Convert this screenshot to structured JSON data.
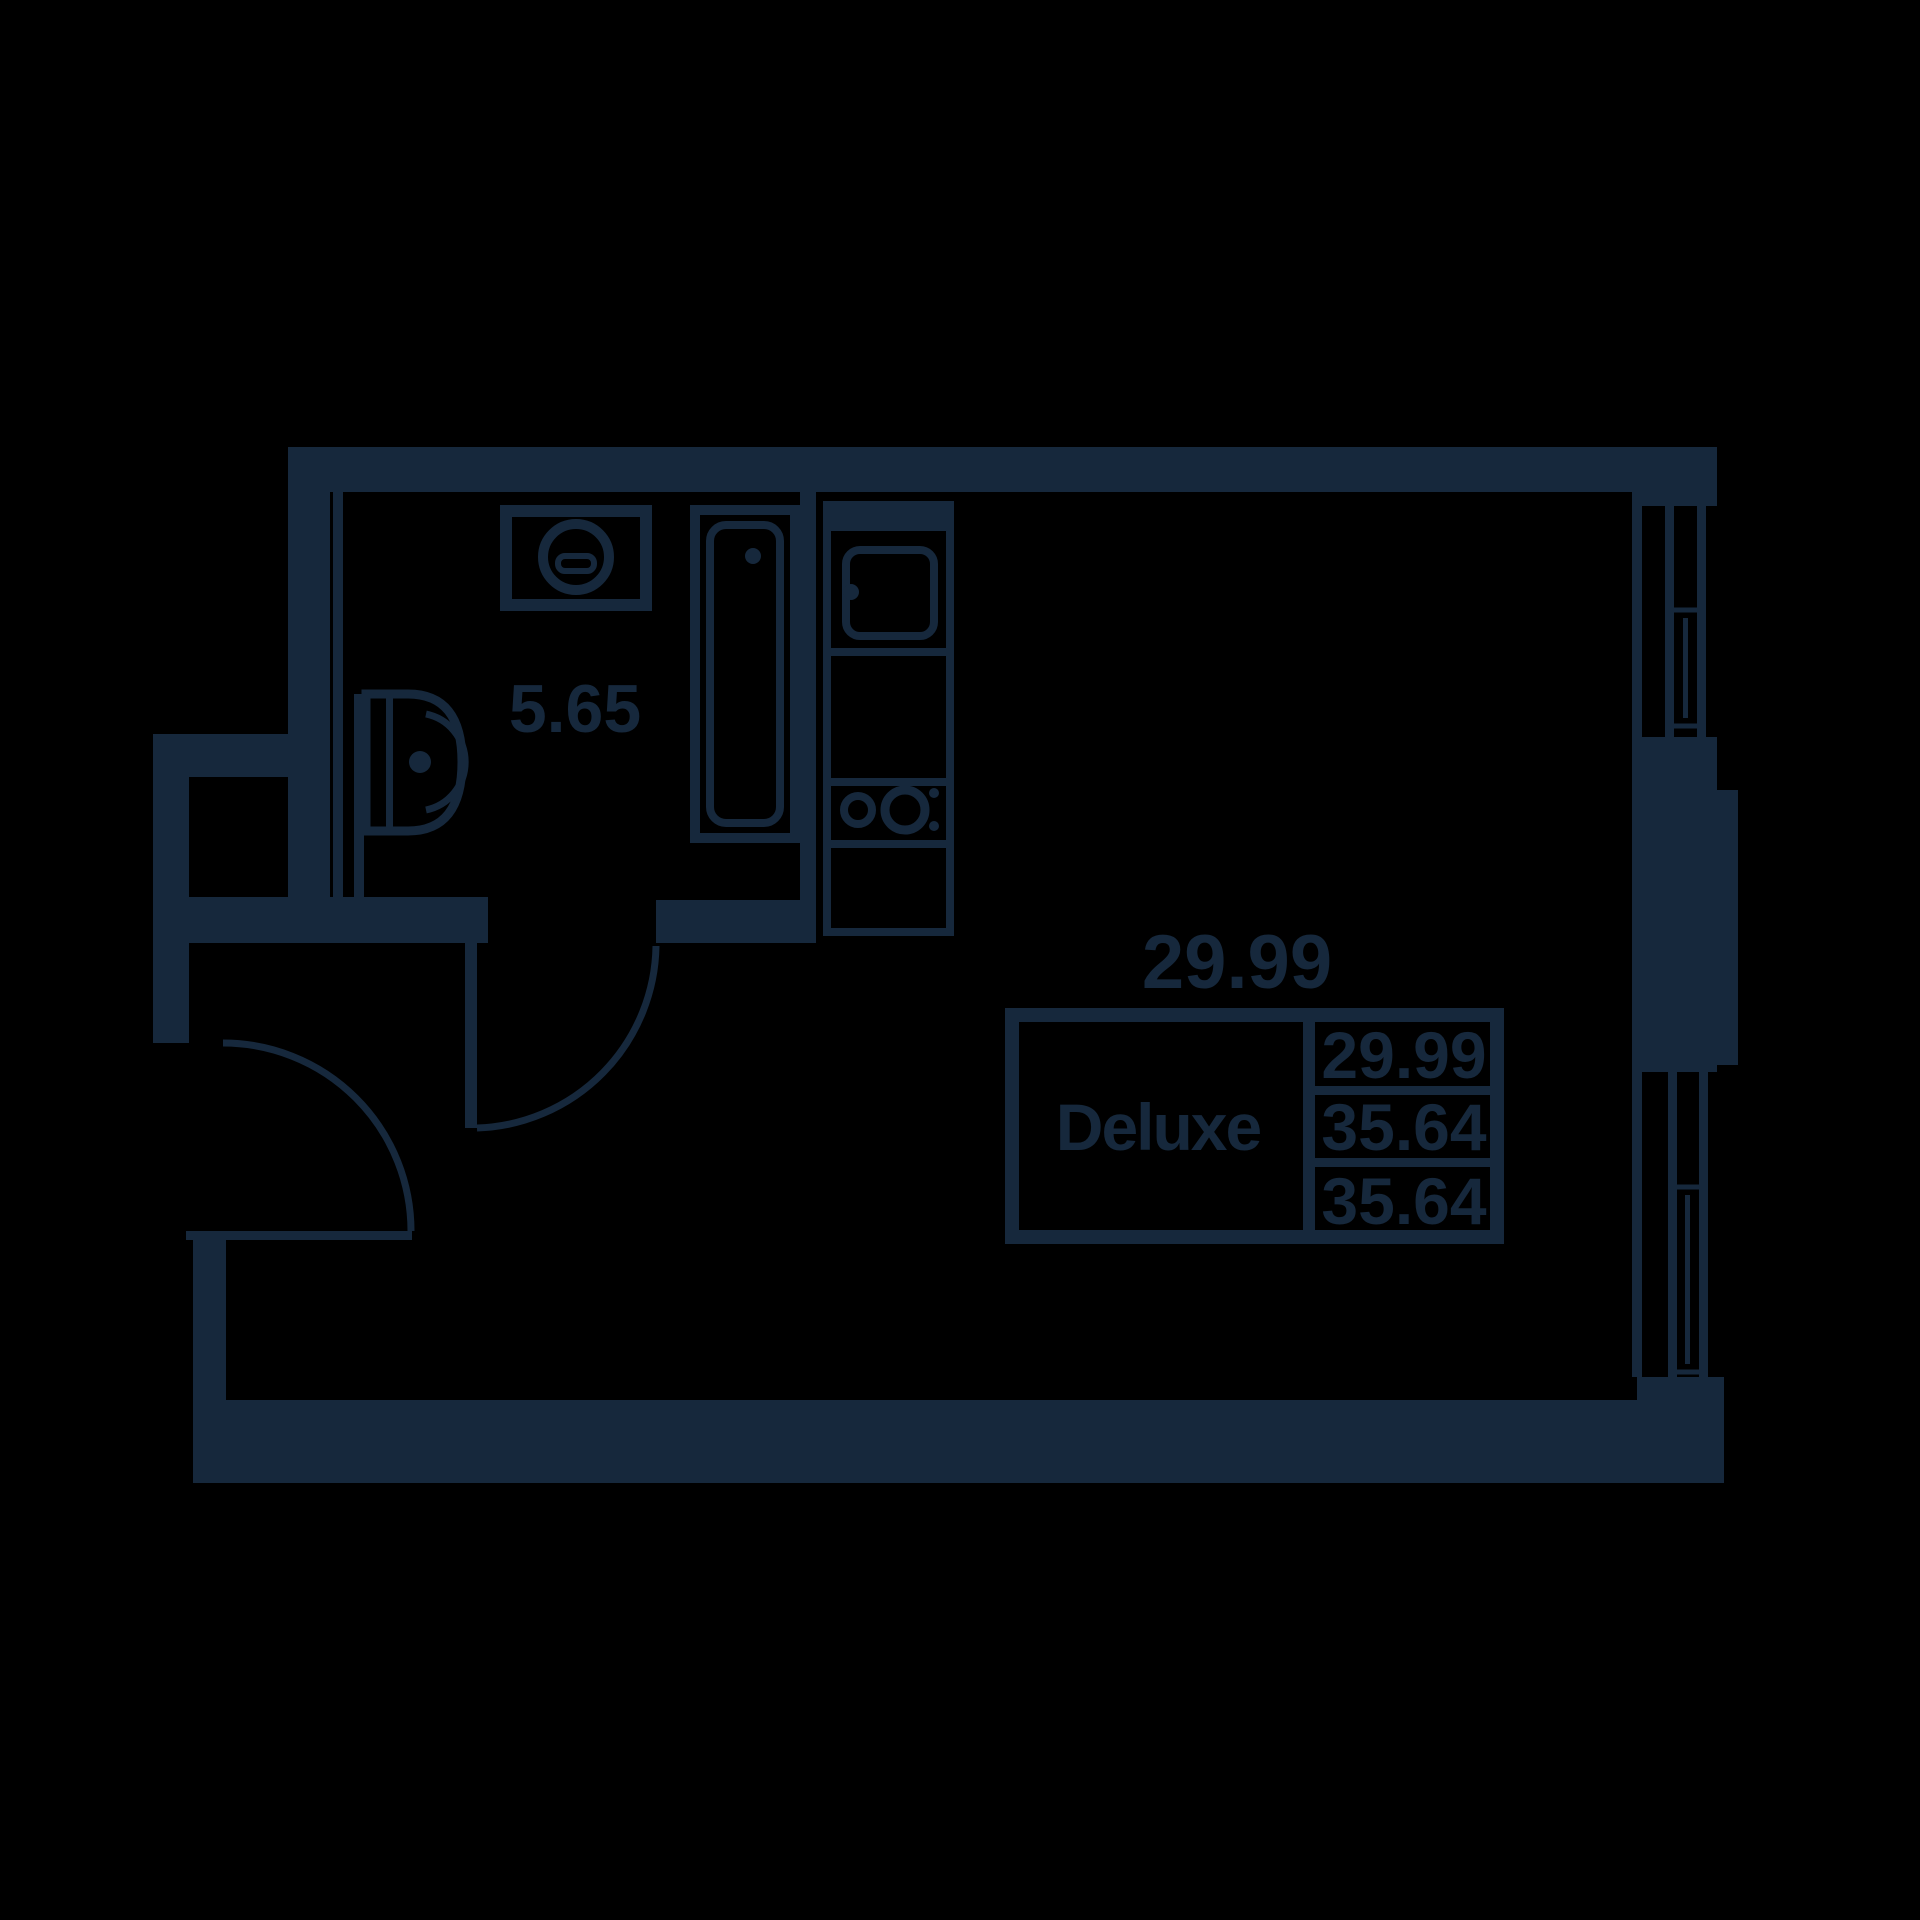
{
  "floorplan": {
    "colors": {
      "background": "#000000",
      "line": "#16283c"
    },
    "labels": {
      "room_area": "29.99",
      "bathroom_area": "5.65"
    },
    "unit_card": {
      "name": "Deluxe",
      "rows": [
        "29.99",
        "35.64",
        "35.64"
      ]
    }
  }
}
